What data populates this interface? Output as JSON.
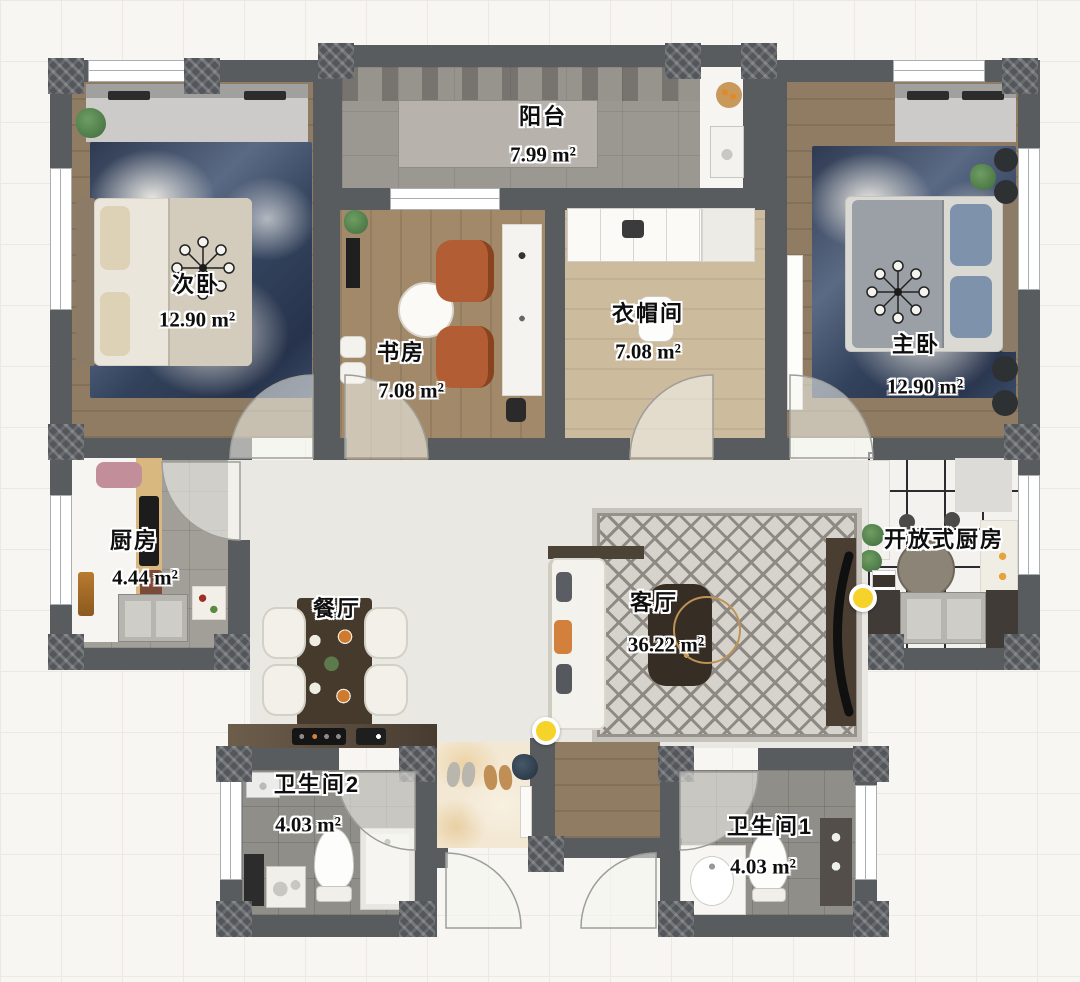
{
  "plan": {
    "rooms": {
      "balcony": {
        "name": "阳台",
        "area": "7.99 m²"
      },
      "secondary_bedroom": {
        "name": "次卧",
        "area": "12.90 m²"
      },
      "study": {
        "name": "书房",
        "area": "7.08 m²"
      },
      "cloakroom": {
        "name": "衣帽间",
        "area": "7.08 m²"
      },
      "master_bedroom": {
        "name": "主卧",
        "area": "12.90 m²"
      },
      "kitchen": {
        "name": "厨房",
        "area": "4.44 m²"
      },
      "dining_room": {
        "name": "餐厅"
      },
      "living_room": {
        "name": "客厅",
        "area": "36.22 m²"
      },
      "open_kitchen": {
        "name": "开放式厨房"
      },
      "bathroom_2": {
        "name": "卫生间2",
        "area": "4.03 m²"
      },
      "bathroom_1": {
        "name": "卫生间1",
        "area": "4.03 m²"
      }
    },
    "markers": {
      "living_entry_light": {
        "icon": "yellow-dot"
      },
      "open_kitchen_light": {
        "icon": "yellow-dot"
      }
    },
    "colors": {
      "wall": "#595c5e",
      "marker_yellow": "#f5d32b",
      "chair_orange": "#b25d33",
      "rug_blue": "#33425c",
      "label_text": "#0e0e0e"
    }
  }
}
